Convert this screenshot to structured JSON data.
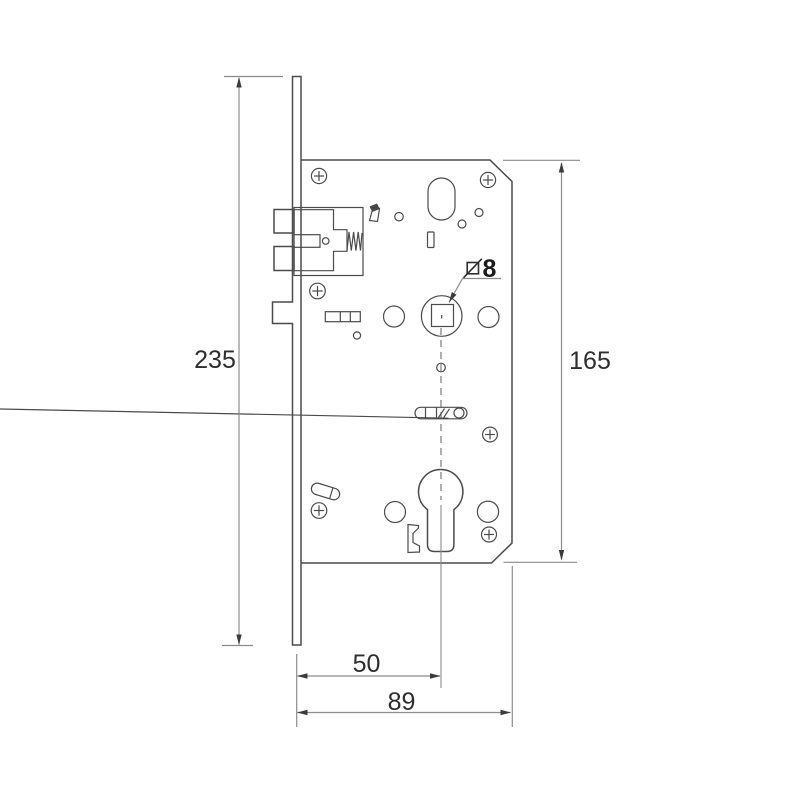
{
  "colors": {
    "background": "#ffffff",
    "outline": "#4b4b4b",
    "dimension": "#8c8c8c",
    "arrow": "#3c3c3c",
    "text": "#2e2e2e"
  },
  "dimensions": {
    "faceplate_height": "235",
    "body_height": "165",
    "backset": "50",
    "overall_width": "89",
    "spindle_square": "8"
  }
}
